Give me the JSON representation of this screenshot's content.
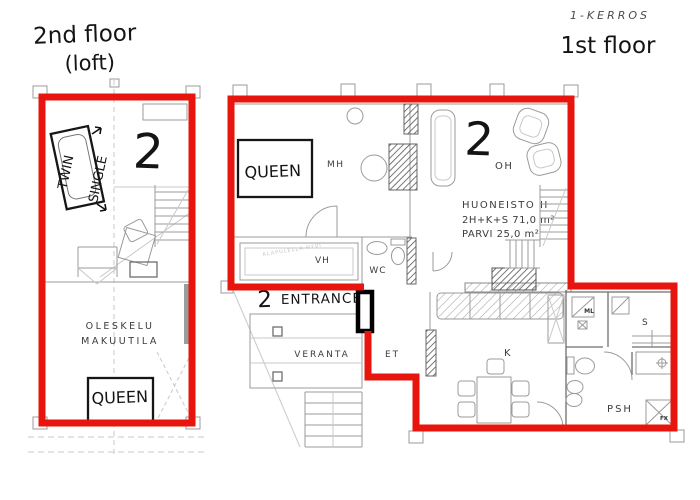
{
  "titles": {
    "left_line1": "2nd floor",
    "left_line2": "(loft)",
    "right_code": "1-KERROS",
    "right_title": "1st floor"
  },
  "left_plan": {
    "unit_number": "2",
    "bed_twin": "TWIN",
    "bed_single": "SINGLE",
    "bed_queen": "QUEEN",
    "room_line1": "OLESKELU",
    "room_line2": "MAKUUTILA"
  },
  "right_plan": {
    "unit_number": "2",
    "bed_queen": "QUEEN",
    "entrance_number": "2",
    "entrance_label": "ENTRANCE",
    "faint_note": "KLAPULELLA HYVI",
    "rooms": {
      "mh": "MH",
      "oh": "OH",
      "vh": "VH",
      "wc": "WC",
      "et": "ET",
      "veranta": "VERANTA",
      "k": "K",
      "s": "S",
      "ml": "ML",
      "psh": "PSH",
      "fx": "FX"
    },
    "info": {
      "line1": "HUONEISTO II",
      "line2": "2H+K+S  71,0 m²",
      "line3": "PARVI  25,0 m²"
    }
  },
  "colors": {
    "outline_red": "#e8150e"
  }
}
